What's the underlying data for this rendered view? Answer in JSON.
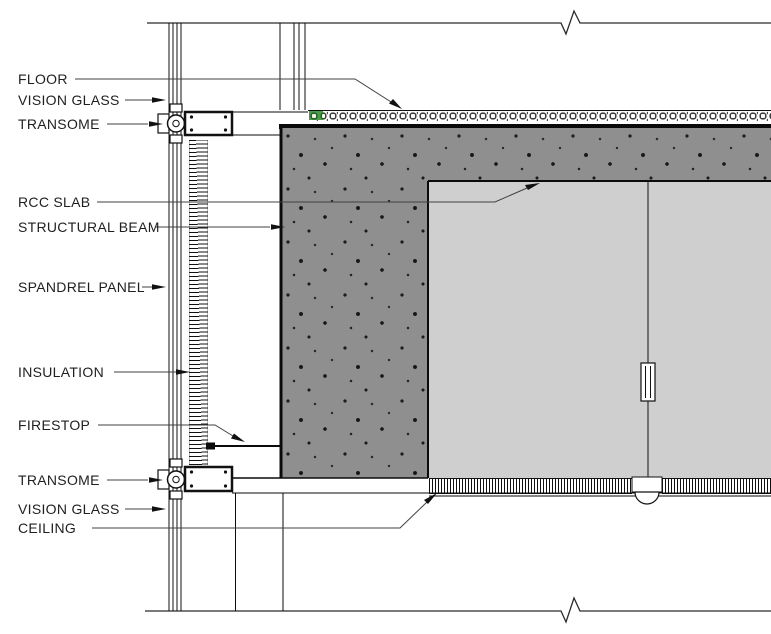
{
  "drawing": {
    "type": "architectural-section-detail",
    "subject": "curtain wall spandrel / floor edge section",
    "labels": [
      {
        "id": "floor",
        "text": "FLOOR"
      },
      {
        "id": "vision-glass-top",
        "text": "VISION GLASS"
      },
      {
        "id": "transome-top",
        "text": "TRANSOME"
      },
      {
        "id": "rcc-slab",
        "text": "RCC SLAB"
      },
      {
        "id": "structural-beam",
        "text": "STRUCTURAL BEAM"
      },
      {
        "id": "spandrel-panel",
        "text": "SPANDREL PANEL"
      },
      {
        "id": "insulation",
        "text": "INSULATION"
      },
      {
        "id": "firestop",
        "text": "FIRESTOP"
      },
      {
        "id": "transome-bottom",
        "text": "TRANSOME"
      },
      {
        "id": "vision-glass-bottom",
        "text": "VISION GLASS"
      },
      {
        "id": "ceiling",
        "text": "CEILING"
      }
    ],
    "colors": {
      "background": "#ffffff",
      "line": "#111111",
      "leader": "#404040",
      "concrete": "#8f8f8f",
      "interior_space": "#cfcfcf",
      "floor_finish_accent": "#4a9b4a"
    }
  }
}
